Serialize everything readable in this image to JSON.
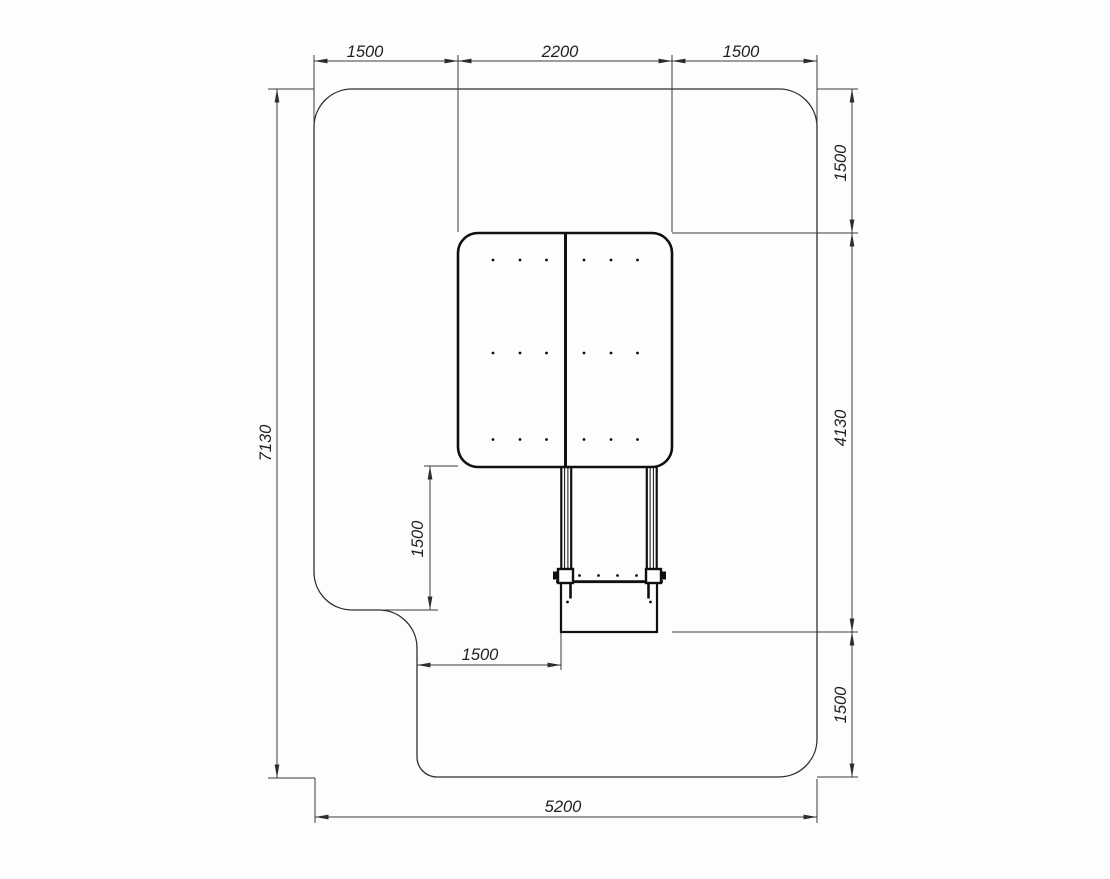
{
  "drawing": {
    "type": "technical-plan-drawing",
    "colors": {
      "background": "#fdfdfd",
      "thin_line": "#3a3a3a",
      "object_line": "#101010",
      "text": "#1f1f1f"
    },
    "dim_labels": {
      "top_left": "1500",
      "top_center": "2200",
      "top_right": "1500",
      "right_upper": "1500",
      "right_middle": "4130",
      "right_lower": "1500",
      "left_overall": "7130",
      "mid_vertical": "1500",
      "mid_horizontal": "1500",
      "bottom_overall": "5200"
    }
  }
}
